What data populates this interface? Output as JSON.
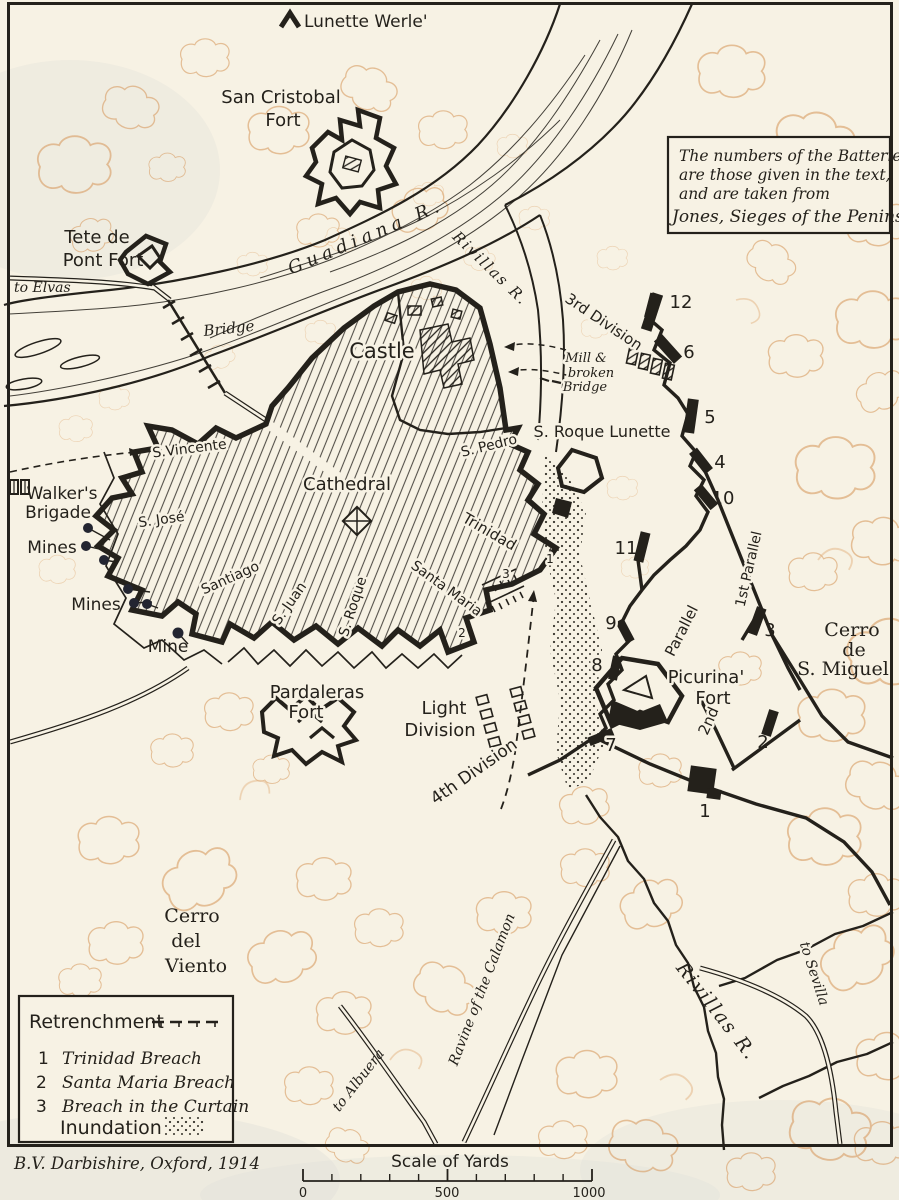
{
  "note": {
    "lines": [
      "The numbers of the Batteries",
      "are those given in the text,",
      "and are taken from",
      "Jones, Sieges of the Peninsula"
    ]
  },
  "labels": {
    "lunette_werle": "Lunette Werle'",
    "san_cristobal": [
      "San Cristobal",
      "Fort"
    ],
    "tete_de_pont": [
      "Tete de",
      "Pont Fort"
    ],
    "to_elvas": "to Elvas",
    "bridge": "Bridge",
    "guadiana": "Guadiana R.",
    "rivillas_upper": "Rivillas R.",
    "rivillas_lower": "Rivillas R.",
    "castle": "Castle",
    "cathedral": "Cathedral",
    "s_vincente": "S.Vincente",
    "s_jose": "S. José",
    "santiago": "Santiago",
    "s_juan": "S. Juan",
    "s_roque_bastion": "S. Roque",
    "santa_maria": "Santa Maria",
    "trinidad": "Trinidad",
    "s_pedro": "S. Pedro",
    "s_roque_lunette": "S. Roque Lunette",
    "mill": [
      "Mill &",
      "broken",
      "Bridge"
    ],
    "third_division": "3rd Division",
    "light_division": [
      "Light",
      "Division"
    ],
    "fourth_division": "4th Division",
    "first_parallel": "1st Parallel",
    "parallel": "Parallel",
    "second_parallel": "2nd",
    "picurina": [
      "Picurina'",
      "Fort"
    ],
    "cerro_miguel": [
      "Cerro",
      "de",
      "S. Miguel"
    ],
    "walkers_brigade": [
      "Walker's",
      "Brigade"
    ],
    "mines_1": "Mines",
    "mines_2": "Mines",
    "mine": "Mine",
    "pardaleras": [
      "Pardaleras",
      "Fort"
    ],
    "cerro_viento": [
      "Cerro",
      "del",
      "Viento"
    ],
    "ravine": "Ravine of the Calamon",
    "to_sevilla": "to Sevilla",
    "to_albuera": "to Albuera"
  },
  "batteries": {
    "b1": "1",
    "b2": "2",
    "b3": "3",
    "b4": "4",
    "b5": "5",
    "b6": "6",
    "b7": "7",
    "b8": "8",
    "b9": "9",
    "b10": "10",
    "b11": "11",
    "b12": "12"
  },
  "breach_markers": {
    "m1": "1",
    "m2": "2",
    "m3": "3"
  },
  "legend": {
    "title": "Retrenchment",
    "items": [
      {
        "num": "1",
        "name": "Trinidad Breach"
      },
      {
        "num": "2",
        "name": "Santa Maria Breach"
      },
      {
        "num": "3",
        "name": "Breach in the Curtain"
      }
    ],
    "inundation": "Inundation"
  },
  "credit": "B.V. Darbishire, Oxford, 1914",
  "scale": {
    "title": "Scale of Yards",
    "t0": "0",
    "t500": "500",
    "t1000": "1000"
  }
}
